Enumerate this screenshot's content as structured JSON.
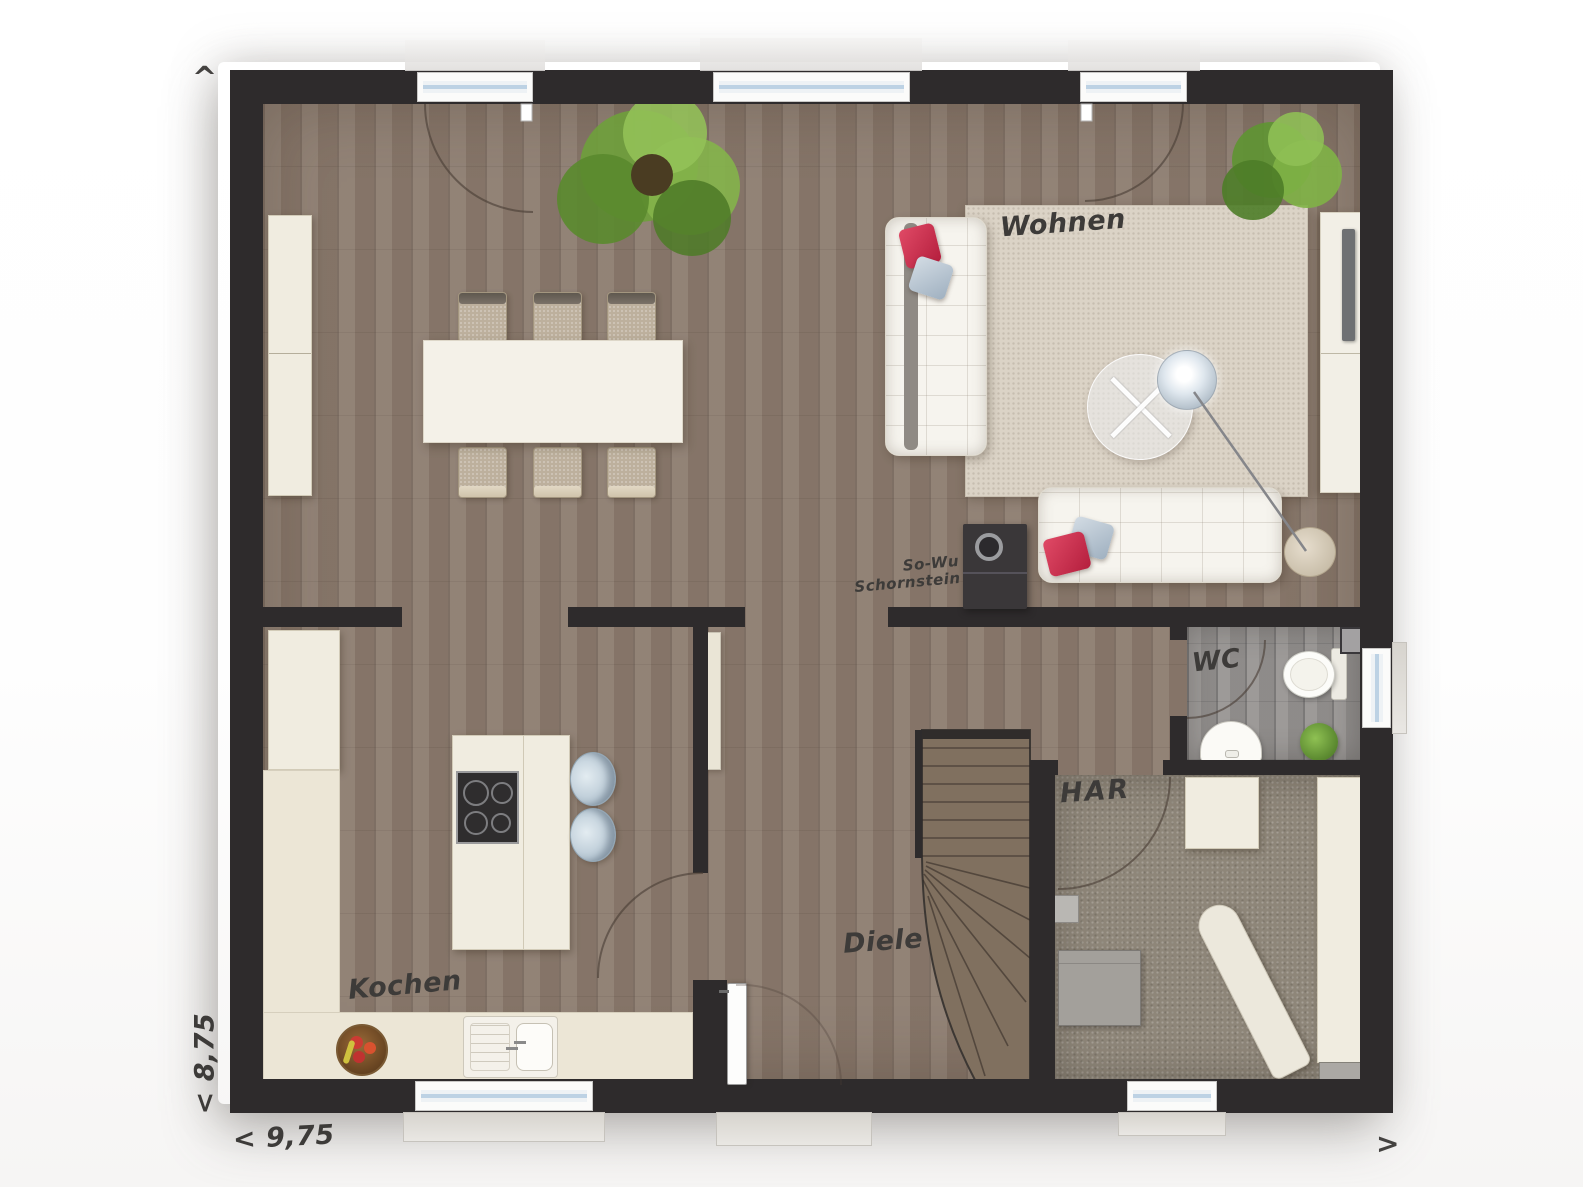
{
  "labels": {
    "wohnen": "Wohnen",
    "kochen": "Kochen",
    "diele": "Diele",
    "wc": "WC",
    "har": "HAR",
    "chimney_line1": "So-Wu",
    "chimney_line2": "Schornstein"
  },
  "dimensions": {
    "width": "< 9,75",
    "depth": "< 8,75"
  },
  "markers": {
    "north": "^",
    "east": ">"
  },
  "colors": {
    "wall": "#2e2b2c",
    "wood_floor": "#8b7b6e",
    "furniture_cream": "#f0ece0",
    "rug": "#dbd3c6",
    "accent_red": "#cf2e4e"
  }
}
